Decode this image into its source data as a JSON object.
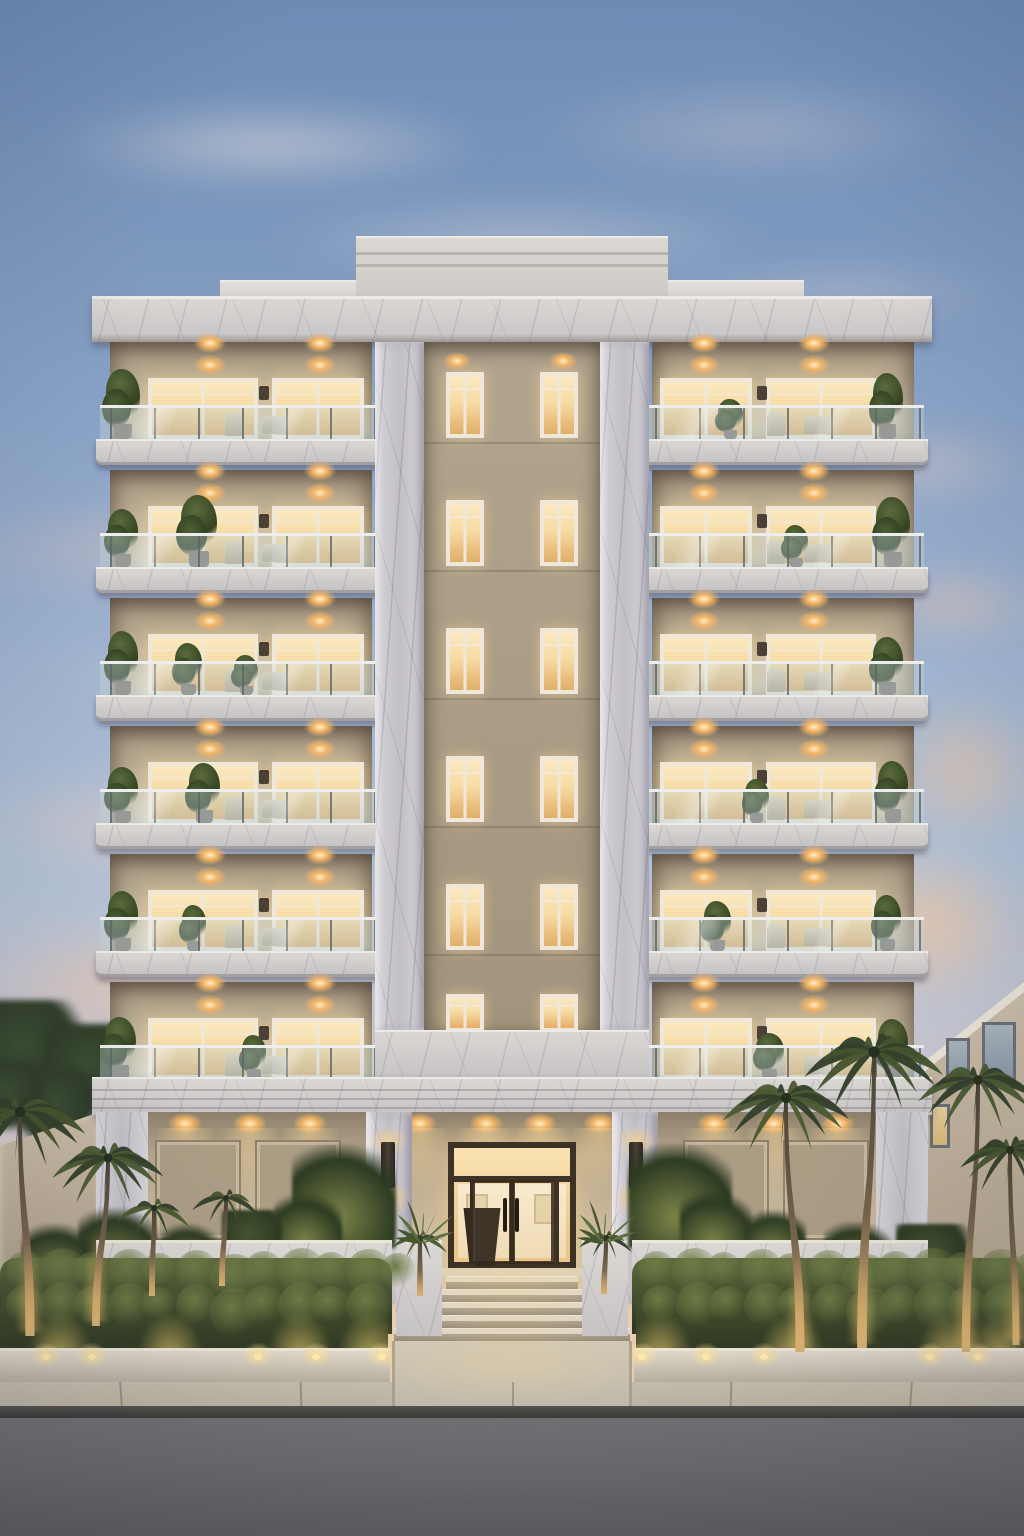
{
  "scene": {
    "width": 1024,
    "height": 1536
  },
  "palette": {
    "skyTop": "#6d8bb4",
    "skyMid": "#8aa3c6",
    "skyLow": "#aebfd5",
    "skyHaze": "#cfc9cf",
    "skyWarm": "#e9cdb4",
    "skyHorizon": "#f2cfae",
    "cloudWhite": "#f2e9e4",
    "cloudPink": "#ecc3b6",
    "cloudPeach": "#f4c49a",
    "marbleLight": "#dedbd8",
    "marbleDark": "#c3c0c4",
    "pillarLight": "#d6d4d9",
    "pillarDark": "#bfbcc4",
    "corniceTop": "#eceae7",
    "parapet1": "#cdc9c4",
    "parapet2": "#d6d2cd",
    "stuccoLight": "#c9baa2",
    "stuccoDark": "#9b8d77",
    "recess1": "#b2a58f",
    "recess2": "#a2947e",
    "glowBright": "#fce9c0",
    "glow": "#f6dca6",
    "glowDeep": "#e2ae66",
    "frame": "#efe8da",
    "glass": "rgba(186,208,214,0.45)",
    "rail": "#eceeed",
    "post": "#5f6568",
    "porch1": "#b6a78e",
    "porch2": "#d2c1a2",
    "panel": "#ab9c84",
    "doorFrame": "#3e3227",
    "doorGlass1": "#f8e2b2",
    "doorGlass2": "#eac685",
    "lobby": "#f9ead0",
    "lobbyPlanter": "#33291e",
    "tread": "#ded7c9",
    "riser": "#a99f8e",
    "cheek": "#d8d2c6",
    "hedge1": "#55603a",
    "hedge2": "#2a3320",
    "hedgeLit": "#a8a860",
    "bumpA": "#6c7a44",
    "bumpB": "#39452a",
    "planterWall": "#cfc8ba",
    "terraceWall": "#d6cec0",
    "sidewalk": "#bcb4a4",
    "walkway": "#cfc8b8",
    "curb": "#3a3935",
    "road1": "#727074",
    "road2": "#5c5b5f",
    "treeDark": "#2e3c28",
    "shrubLit": "#7c8448",
    "palmA": "#33402a",
    "palmB": "#4a5a32",
    "trunkTop": "#4a4237",
    "trunkWarm": "#d8b176",
    "neighbor1": "#cabda8",
    "neighbor2": "#b3a68f",
    "neighborFascia": "#e9e3d7",
    "neighborGlass": "#a9b4bd",
    "wallBeige": "#c9bba5",
    "lightCore": "#ffefc4",
    "lightHalo": "#f0b468",
    "sconce": "#3a332b"
  },
  "sky": {
    "clouds": [
      {
        "x": 40,
        "y": 100,
        "w": 460,
        "h": 90,
        "c": "#f2e9e4",
        "o": 0.5,
        "b": 16
      },
      {
        "x": 260,
        "y": 200,
        "w": 520,
        "h": 80,
        "c": "#f2e9e4",
        "o": 0.38,
        "b": 18
      },
      {
        "x": 520,
        "y": 80,
        "w": 460,
        "h": 100,
        "c": "#eedfda",
        "o": 0.32,
        "b": 20
      },
      {
        "x": 660,
        "y": 260,
        "w": 360,
        "h": 70,
        "c": "#f0dcd4",
        "o": 0.3,
        "b": 16
      },
      {
        "x": -60,
        "y": 500,
        "w": 420,
        "h": 100,
        "c": "#ecc3b6",
        "o": 0.42,
        "b": 18
      },
      {
        "x": 30,
        "y": 630,
        "w": 440,
        "h": 90,
        "c": "#f0d0c4",
        "o": 0.4,
        "b": 18
      },
      {
        "x": -40,
        "y": 770,
        "w": 330,
        "h": 110,
        "c": "#eec9b8",
        "o": 0.46,
        "b": 18
      },
      {
        "x": -30,
        "y": 920,
        "w": 290,
        "h": 130,
        "c": "#f2c4a4",
        "o": 0.52,
        "b": 16
      },
      {
        "x": 820,
        "y": 420,
        "w": 220,
        "h": 90,
        "c": "#eccfc2",
        "o": 0.4,
        "b": 16
      },
      {
        "x": 860,
        "y": 560,
        "w": 190,
        "h": 90,
        "c": "#f0c6ae",
        "o": 0.46,
        "b": 14
      },
      {
        "x": 880,
        "y": 690,
        "w": 170,
        "h": 160,
        "c": "#f4c49a",
        "o": 0.55,
        "b": 16
      },
      {
        "x": 830,
        "y": 840,
        "w": 200,
        "h": 170,
        "c": "#f6c79c",
        "o": 0.66,
        "b": 14
      },
      {
        "x": 100,
        "y": 1000,
        "w": 200,
        "h": 90,
        "c": "#edc2a8",
        "o": 0.45,
        "b": 14
      }
    ]
  },
  "building": {
    "facade": {
      "x": 96,
      "w": 832,
      "top": 296
    },
    "parapetCenter": {
      "x": 356,
      "y": 236,
      "w": 312,
      "h": 62
    },
    "parapetSide": {
      "x": 220,
      "y": 280,
      "w": 584,
      "h": 18
    },
    "cornice": {
      "x": 92,
      "y": 296,
      "w": 840,
      "h": 46
    },
    "floors": {
      "count": 6,
      "top": 342,
      "pitch": 128,
      "interiorH": 97,
      "railTop": 63,
      "railH": 34,
      "slabH": 26
    },
    "wings": {
      "left": {
        "x": 110,
        "w": 262
      },
      "right": {
        "x": 652,
        "w": 262
      }
    },
    "slabs": {
      "left": {
        "x": 96,
        "w": 283
      },
      "right": {
        "x": 645,
        "w": 283
      }
    },
    "pillars": [
      {
        "x": 375,
        "w": 49
      },
      {
        "x": 600,
        "w": 49
      }
    ],
    "recess": {
      "x": 424,
      "w": 176,
      "bottom": 1030
    },
    "recessWindows": {
      "xs": [
        446,
        540
      ],
      "w": 38,
      "dy": 30,
      "h": 66,
      "lastDy": 12,
      "lastH": 38
    },
    "recessTopLights": [
      457,
      563
    ],
    "centerBand": {
      "x": 375,
      "y": 1030,
      "w": 274,
      "h": 47
    },
    "architrave": {
      "x": 92,
      "y": 1077,
      "w": 840,
      "h": 38
    },
    "wingWindows": {
      "left": [
        {
          "x": 148,
          "w": 110
        },
        {
          "x": 272,
          "w": 92
        }
      ],
      "right": [
        {
          "x": 660,
          "w": 92
        },
        {
          "x": 766,
          "w": 110
        }
      ]
    },
    "ceilLights": {
      "left": [
        210,
        320
      ],
      "right": [
        704,
        814
      ],
      "dy": 22
    },
    "wallBox": {
      "left": 259,
      "right": 757,
      "w": 10,
      "h": 14,
      "dy": 44
    },
    "plantsLeft": [
      [
        {
          "p": 0.05,
          "h": 70,
          "s": 1.1
        }
      ],
      [
        {
          "p": 0.05,
          "h": 58,
          "s": 1
        },
        {
          "p": 0.34,
          "h": 72,
          "s": 1.2
        }
      ],
      [
        {
          "p": 0.05,
          "h": 64,
          "s": 1
        },
        {
          "p": 0.3,
          "h": 52,
          "s": 0.9
        },
        {
          "p": 0.52,
          "h": 40,
          "s": 0.8
        }
      ],
      [
        {
          "p": 0.05,
          "h": 56,
          "s": 1
        },
        {
          "p": 0.36,
          "h": 60,
          "s": 1
        }
      ],
      [
        {
          "p": 0.05,
          "h": 60,
          "s": 1
        },
        {
          "p": 0.32,
          "h": 46,
          "s": 0.8
        }
      ],
      [
        {
          "p": 0.04,
          "h": 62,
          "s": 1
        },
        {
          "p": 0.55,
          "h": 44,
          "s": 0.8
        }
      ]
    ],
    "plantsRight": [
      [
        {
          "p": 0.9,
          "h": 66,
          "s": 1
        },
        {
          "p": 0.3,
          "h": 40,
          "s": 0.8
        }
      ],
      [
        {
          "p": 0.92,
          "h": 70,
          "s": 1.1
        },
        {
          "p": 0.55,
          "h": 42,
          "s": 0.8
        }
      ],
      [
        {
          "p": 0.9,
          "h": 58,
          "s": 1
        }
      ],
      [
        {
          "p": 0.92,
          "h": 62,
          "s": 1
        },
        {
          "p": 0.4,
          "h": 44,
          "s": 0.8
        }
      ],
      [
        {
          "p": 0.9,
          "h": 56,
          "s": 0.9
        },
        {
          "p": 0.25,
          "h": 50,
          "s": 0.9
        }
      ],
      [
        {
          "p": 0.92,
          "h": 60,
          "s": 1
        },
        {
          "p": 0.45,
          "h": 46,
          "s": 0.9
        }
      ]
    ],
    "furniture": [
      0.44,
      0.58
    ]
  },
  "porch": {
    "wall": {
      "x": 104,
      "y": 1112,
      "w": 816,
      "h": 196
    },
    "cornerPiers": [
      {
        "x": 96,
        "w": 52
      },
      {
        "x": 876,
        "w": 52
      }
    ],
    "entrancePillars": [
      {
        "x": 366,
        "w": 46
      },
      {
        "x": 612,
        "w": 46
      }
    ],
    "pillarY": 1112,
    "pillarH": 192,
    "panels": [
      {
        "x": 155,
        "w": 86
      },
      {
        "x": 255,
        "w": 86
      },
      {
        "x": 683,
        "w": 86
      },
      {
        "x": 783,
        "w": 86
      }
    ],
    "panelY": 1140,
    "panelH": 100,
    "downlights": [
      185,
      250,
      310,
      420,
      486,
      540,
      600,
      714,
      774,
      838
    ],
    "downlightY": 1122,
    "sconces": [
      {
        "x": 381
      },
      {
        "x": 629
      }
    ],
    "sconceY": 1142,
    "sconceW": 14,
    "sconceH": 46
  },
  "entrance": {
    "frame": {
      "x": 448,
      "y": 1142,
      "w": 128,
      "h": 126
    },
    "transomY": 1176,
    "sidelightXs": [
      470,
      554
    ],
    "doorSplit": 512,
    "handles": [
      {
        "x": 503
      },
      {
        "x": 515
      }
    ],
    "handleY": 1198,
    "handleH": 34,
    "landing": {
      "x": 440,
      "y": 1268,
      "w": 144,
      "h": 8
    },
    "steps": {
      "count": 5,
      "y": 1276,
      "stepH": 13,
      "halfW0": 66,
      "grow": 13
    },
    "cheeks": [
      {
        "x": 396
      },
      {
        "x": 582
      }
    ],
    "cheekY": 1240,
    "cheekW": 46,
    "cheekH": 96,
    "agaves": [
      {
        "x": 421
      },
      {
        "x": 603
      }
    ],
    "agaveY": 1244
  },
  "landscape": {
    "terraceWalls": [
      {
        "x": 96,
        "w": 296
      },
      {
        "x": 632,
        "w": 296
      }
    ],
    "terraceY": 1240,
    "terraceH": 78,
    "hedgeBack": [
      {
        "x": 0,
        "w": 392
      },
      {
        "x": 632,
        "w": 392
      }
    ],
    "hedgeBackY": 1258,
    "hedgeBackH": 76,
    "hedgeFront": [
      {
        "x": 0,
        "w": 388
      },
      {
        "x": 636,
        "w": 388
      }
    ],
    "hedgeFrontY": 1292,
    "hedgeFrontH": 70,
    "planterWalls": [
      {
        "x": 0,
        "w": 390
      },
      {
        "x": 634,
        "w": 390
      }
    ],
    "planterY": 1348,
    "planterH": 36,
    "wallLights": [
      46,
      92,
      258,
      316,
      382,
      642,
      706,
      764,
      930,
      978
    ],
    "wallLightY": 1354,
    "hedgeGlows": [
      60,
      170,
      300,
      370,
      660,
      792,
      950,
      1000
    ],
    "hedgeGlowY": 1318,
    "porchShrubs": [
      {
        "x": 344,
        "y": 1196,
        "r": 52,
        "lit": 1
      },
      {
        "x": 308,
        "y": 1228,
        "r": 34,
        "lit": 1
      },
      {
        "x": 680,
        "y": 1196,
        "r": 52,
        "lit": 1
      },
      {
        "x": 716,
        "y": 1228,
        "r": 36,
        "lit": 1
      },
      {
        "x": 252,
        "y": 1240,
        "r": 30,
        "lit": 0
      },
      {
        "x": 776,
        "y": 1240,
        "r": 30,
        "lit": 1
      }
    ],
    "courtShrubs": [
      {
        "x": 118,
        "y": 1248,
        "r": 40,
        "lit": 1
      },
      {
        "x": 58,
        "y": 1260,
        "r": 36,
        "lit": 1
      },
      {
        "x": 190,
        "y": 1254,
        "r": 30,
        "lit": 1
      },
      {
        "x": 858,
        "y": 1256,
        "r": 34,
        "lit": 1
      },
      {
        "x": 932,
        "y": 1260,
        "r": 36,
        "lit": 0
      }
    ],
    "treesLeft": [
      {
        "x": 28,
        "y": 1056,
        "r": 56
      },
      {
        "x": 92,
        "y": 1072,
        "r": 48
      },
      {
        "x": 58,
        "y": 1110,
        "r": 40
      },
      {
        "x": 10,
        "y": 1098,
        "r": 36
      }
    ],
    "perimeterWall": {
      "x": 0,
      "y": 1112,
      "w": 100,
      "h": 240,
      "topDrop": 34
    },
    "neighbor": {
      "x": 924,
      "y": 992,
      "w": 100,
      "h": 360,
      "slant": 80,
      "windows": [
        {
          "x": 946,
          "y": 1038,
          "w": 24,
          "h": 52,
          "lit": 0
        },
        {
          "x": 982,
          "y": 1022,
          "w": 34,
          "h": 64,
          "lit": 0
        },
        {
          "x": 930,
          "y": 1104,
          "w": 20,
          "h": 44,
          "lit": 1
        }
      ]
    },
    "palms": [
      {
        "bx": 30,
        "by": 1336,
        "tx": 20,
        "ty": 1112,
        "spread": 132,
        "c": 0
      },
      {
        "bx": 96,
        "by": 1326,
        "tx": 108,
        "ty": 1158,
        "spread": 112,
        "c": 1
      },
      {
        "bx": 152,
        "by": 1296,
        "tx": 154,
        "ty": 1208,
        "spread": 74,
        "c": 1
      },
      {
        "bx": 222,
        "by": 1286,
        "tx": 226,
        "ty": 1198,
        "spread": 68,
        "c": 0
      },
      {
        "bx": 420,
        "by": 1296,
        "tx": 420,
        "ty": 1238,
        "spread": 56,
        "c": 1
      },
      {
        "bx": 604,
        "by": 1294,
        "tx": 606,
        "ty": 1238,
        "spread": 54,
        "c": 0
      },
      {
        "bx": 800,
        "by": 1352,
        "tx": 786,
        "ty": 1098,
        "spread": 128,
        "c": 1
      },
      {
        "bx": 862,
        "by": 1348,
        "tx": 874,
        "ty": 1052,
        "spread": 140,
        "c": 0
      },
      {
        "bx": 966,
        "by": 1352,
        "tx": 978,
        "ty": 1080,
        "spread": 120,
        "c": 1
      },
      {
        "bx": 1016,
        "by": 1345,
        "tx": 1010,
        "ty": 1150,
        "spread": 100,
        "c": 0
      }
    ],
    "palmAngles": [
      -175,
      -150,
      -125,
      -100,
      -78,
      -55,
      -30,
      -8,
      15,
      40,
      65,
      95,
      125,
      155
    ],
    "palmLens": [
      1,
      0.85,
      0.95,
      0.8,
      1,
      0.9,
      0.85,
      1,
      0.9,
      0.8,
      0.95,
      0.85,
      1,
      0.9
    ]
  },
  "street": {
    "walkway": {
      "x": 392,
      "y": 1341,
      "w": 240,
      "h": 66
    },
    "sidewalk": {
      "y": 1382,
      "h": 24
    },
    "joints": [
      120,
      300,
      512,
      730,
      910
    ],
    "curb": {
      "y": 1406,
      "h": 12
    },
    "road": {
      "y": 1418,
      "h": 118
    },
    "entryGlow": {
      "x": 512,
      "y": 1360,
      "w": 300,
      "h": 90
    }
  }
}
